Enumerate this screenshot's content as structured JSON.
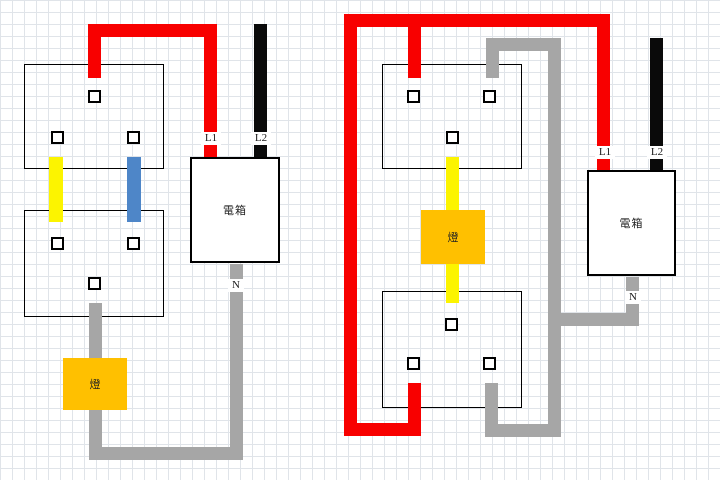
{
  "title": "two-way-switch-wiring-diagrams",
  "colors": {
    "live": "#f80000",
    "supply_black": "#0a0a0a",
    "neutral": "#a6a6a6",
    "switch_leg_yellow": "#fcf400",
    "traveler_blue": "#4e86c8",
    "lamp_fill": "#ffc000",
    "grid_line": "#e0e4e9",
    "canvas": "#ffffff"
  },
  "diagrams": [
    {
      "id": "left",
      "panel_label": "電箱",
      "lamp_label": "燈",
      "l1_label": "L1",
      "l2_label": "L2",
      "n_label": "N"
    },
    {
      "id": "right",
      "panel_label": "電箱",
      "lamp_label": "燈",
      "l1_label": "L1",
      "l2_label": "L2",
      "n_label": "N"
    }
  ]
}
